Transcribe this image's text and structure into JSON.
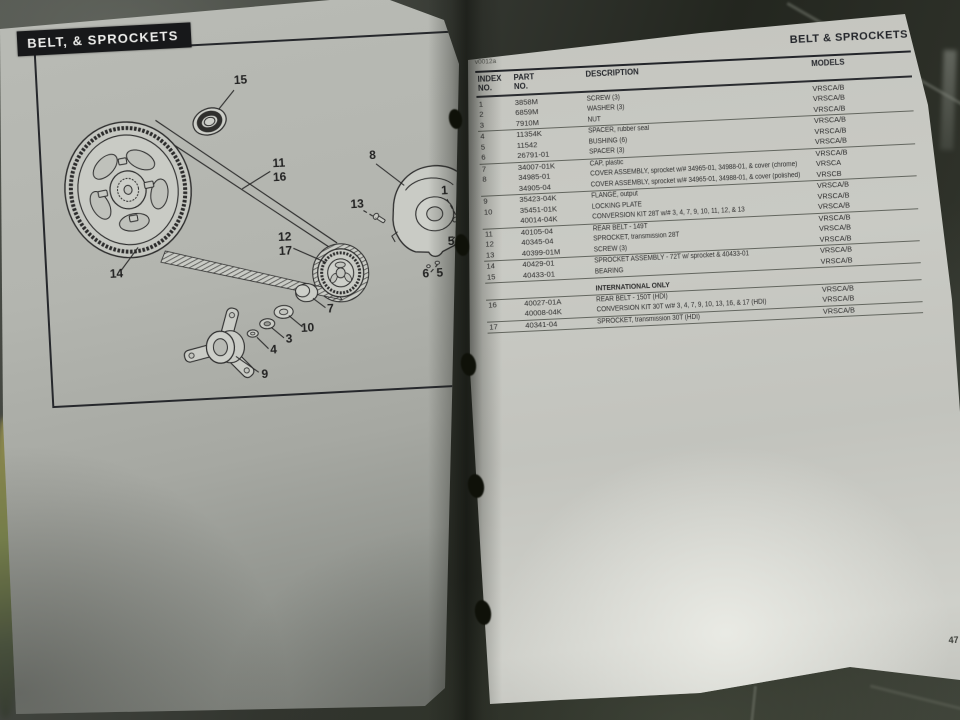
{
  "left_page": {
    "title": "BELT, & SPROCKETS",
    "diagram_callouts": [
      {
        "t": "15",
        "x": 203,
        "y": 40
      },
      {
        "t": "11",
        "x": 237,
        "y": 125
      },
      {
        "t": "16",
        "x": 237,
        "y": 139
      },
      {
        "t": "8",
        "x": 331,
        "y": 122
      },
      {
        "t": "13",
        "x": 313,
        "y": 170
      },
      {
        "t": "12",
        "x": 239,
        "y": 199
      },
      {
        "t": "17",
        "x": 239,
        "y": 213
      },
      {
        "t": "14",
        "x": 69,
        "y": 227
      },
      {
        "t": "1",
        "x": 401,
        "y": 161
      },
      {
        "t": "5",
        "x": 405,
        "y": 212
      },
      {
        "t": "2",
        "x": 416,
        "y": 215
      },
      {
        "t": "6",
        "x": 378,
        "y": 243
      },
      {
        "t": "5",
        "x": 392,
        "y": 243
      },
      {
        "t": "7",
        "x": 281,
        "y": 273
      },
      {
        "t": "10",
        "x": 257,
        "y": 291
      },
      {
        "t": "3",
        "x": 238,
        "y": 301
      },
      {
        "t": "4",
        "x": 222,
        "y": 311
      },
      {
        "t": "9",
        "x": 212,
        "y": 335
      }
    ]
  },
  "right_page": {
    "header": "BELT & SPROCKETS",
    "figure_code": "v0012a",
    "page_number": "47",
    "table": {
      "columns": [
        {
          "l1": "INDEX",
          "l2": "NO."
        },
        {
          "l1": "PART",
          "l2": "NO."
        },
        {
          "l1": "DESCRIPTION",
          "l2": ""
        },
        {
          "l1": "MODELS",
          "l2": ""
        }
      ],
      "rows": [
        {
          "index": "1",
          "part": "3858M",
          "desc": "SCREW (3)",
          "models": "VRSCA/B"
        },
        {
          "index": "2",
          "part": "6859M",
          "desc": "WASHER (3)",
          "models": "VRSCA/B"
        },
        {
          "index": "3",
          "part": "7910M",
          "desc": "NUT",
          "models": "VRSCA/B",
          "rule": true
        },
        {
          "index": "4",
          "part": "11354K",
          "desc": "SPACER, rubber seal",
          "models": "VRSCA/B"
        },
        {
          "index": "5",
          "part": "11542",
          "desc": "BUSHING (6)",
          "models": "VRSCA/B"
        },
        {
          "index": "6",
          "part": "26791-01",
          "desc": "SPACER (3)",
          "models": "VRSCA/B",
          "rule": true
        },
        {
          "index": "7",
          "part": "34007-01K",
          "desc": "CAP, plastic",
          "models": "VRSCA/B"
        },
        {
          "index": "8",
          "part": "34985-01",
          "desc": "COVER ASSEMBLY, sprocket w/# 34965-01, 34988-01, & cover (chrome)",
          "models": "VRSCA"
        },
        {
          "index": "",
          "part": "34905-04",
          "desc": "COVER ASSEMBLY, sprocket w/# 34965-01, 34988-01, & cover (polished)",
          "models": "VRSCB",
          "rule": true
        },
        {
          "index": "9",
          "part": "35423-04K",
          "desc": "FLANGE, output",
          "models": "VRSCA/B"
        },
        {
          "index": "10",
          "part": "35451-01K",
          "desc": "LOCKING PLATE",
          "models": "VRSCA/B"
        },
        {
          "index": "",
          "part": "40014-04K",
          "desc": "CONVERSION KIT 28T w/# 3, 4, 7, 9, 10, 11, 12, & 13",
          "models": "VRSCA/B",
          "rule": true
        },
        {
          "index": "11",
          "part": "40105-04",
          "desc": "REAR BELT - 149T",
          "models": "VRSCA/B"
        },
        {
          "index": "12",
          "part": "40345-04",
          "desc": "SPROCKET, transmission 28T",
          "models": "VRSCA/B"
        },
        {
          "index": "13",
          "part": "40399-01M",
          "desc": "SCREW (3)",
          "models": "VRSCA/B",
          "rule": true
        },
        {
          "index": "14",
          "part": "40429-01",
          "desc": "SPROCKET ASSEMBLY - 72T w/ sprocket & 40433-01",
          "models": "VRSCA/B"
        },
        {
          "index": "15",
          "part": "40433-01",
          "desc": "BEARING",
          "models": "VRSCA/B",
          "rule": true
        },
        {
          "heading": true,
          "index": "",
          "part": "",
          "desc": "INTERNATIONAL ONLY",
          "models": "",
          "rule": true
        },
        {
          "index": "16",
          "part": "40027-01A",
          "desc": "REAR BELT - 150T (HDI)",
          "models": "VRSCA/B"
        },
        {
          "index": "",
          "part": "40008-04K",
          "desc": "CONVERSION KIT 30T w/# 3, 4, 7, 9, 10, 13, 16, & 17 (HDI)",
          "models": "VRSCA/B",
          "rule": true
        },
        {
          "index": "17",
          "part": "40341-04",
          "desc": "SPROCKET, transmission 30T (HDI)",
          "models": "VRSCA/B",
          "rule": true
        }
      ]
    }
  },
  "colors": {
    "title_bar_bg": "#17181a",
    "paper_left": "#b2b4ae",
    "paper_right": "#c7c8c2",
    "ink": "#2b2b2b",
    "floor_dark": "#23261f"
  }
}
